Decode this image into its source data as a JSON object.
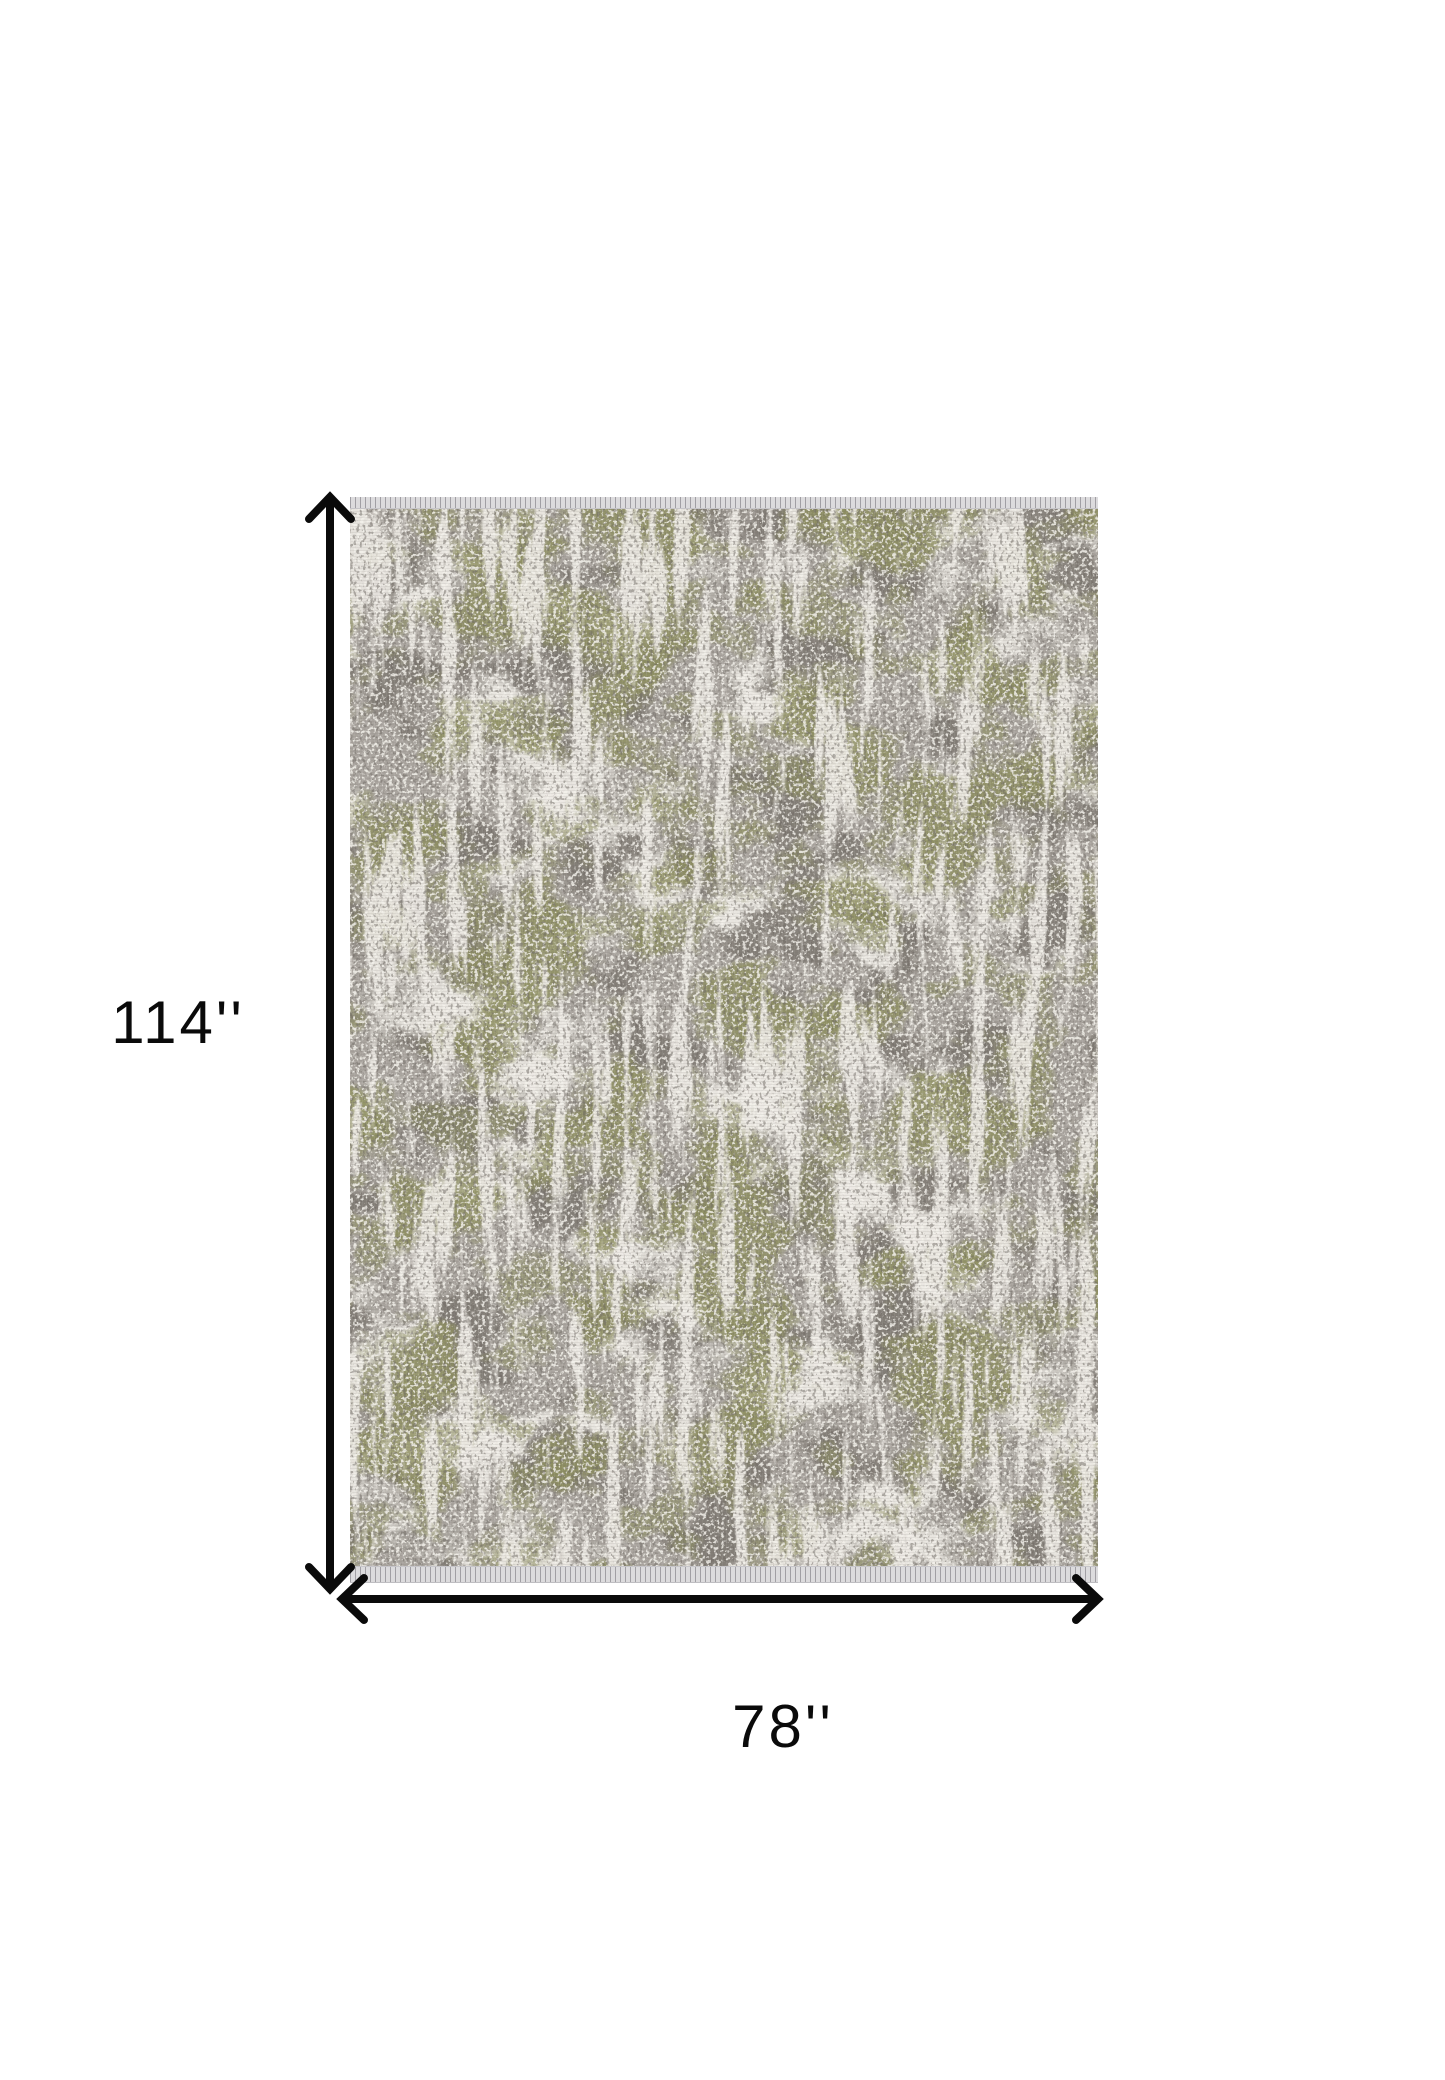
{
  "diagram": {
    "type": "product-dimensions",
    "background_color": "#ffffff"
  },
  "rug": {
    "name": "distressed-abstract-area-rug",
    "colors": {
      "base_ivory": "#e8e5df",
      "gray_wash": "#a29d97",
      "dark_gray": "#7d7770",
      "olive_green": "#8d8e5e",
      "light_streak": "#edeae4",
      "speckle_white": "#f3f1eb",
      "speckle_dark": "#6e6862",
      "fringe": "#dcdbdd",
      "fringe_thread": "#b3b2b6"
    }
  },
  "dimensions": {
    "height": {
      "label": "114''",
      "value_inches": 114
    },
    "width": {
      "label": "78''",
      "value_inches": 78
    },
    "arrow_color": "#0a0a0a",
    "label_color": "#0a0a0a"
  }
}
